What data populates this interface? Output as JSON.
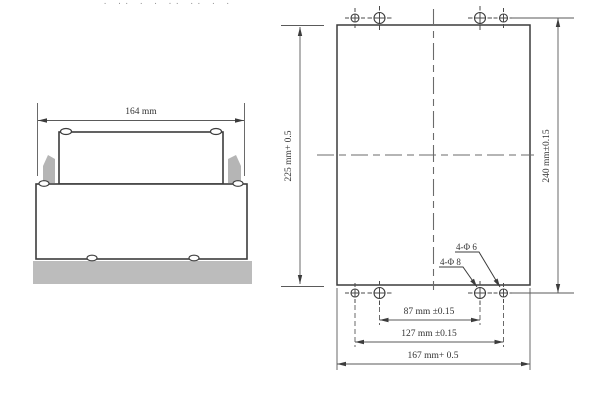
{
  "artifact_marks": "· ·· ·  · ··  ·· ·  ·",
  "side_view": {
    "width_dim_label": "164 mm"
  },
  "front_view": {
    "height_dim_label": "225 mm+ 0.5",
    "hole_row_spacing_dim_label": "240 mm±0.15",
    "inner_hole_spacing_dim_label": "87 mm ±0.15",
    "outer_hole_spacing_dim_label": "127 mm ±0.15",
    "width_dim_label": "167 mm+ 0.5",
    "callout_small_hole": "4-Φ 6",
    "callout_large_hole": "4-Φ 8"
  },
  "colors": {
    "outline": "#3c3c3c",
    "dim_line": "#5a5a5a",
    "centerline": "#6b6b6b",
    "gray_fill": "#b5b5b5",
    "panel_fill": "#bcbcbc",
    "text": "#333333"
  }
}
